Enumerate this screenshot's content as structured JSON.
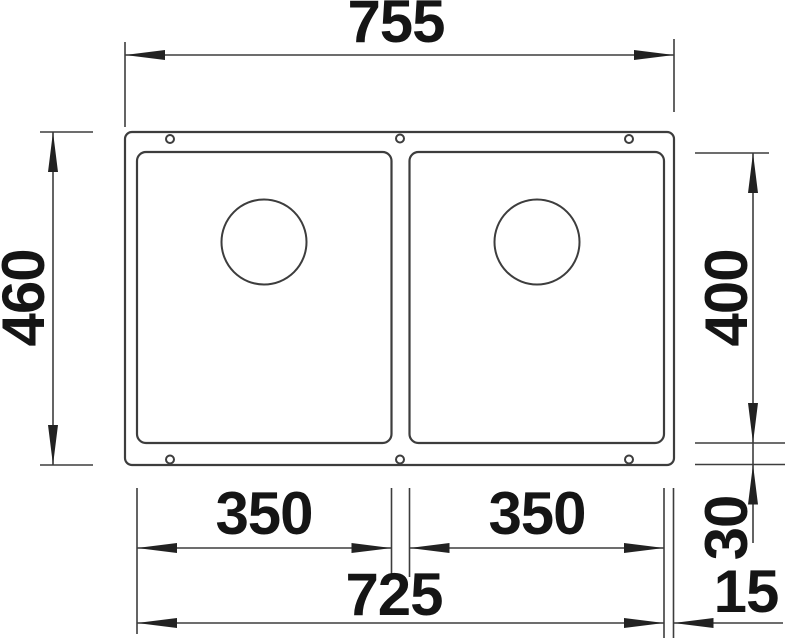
{
  "diagram": {
    "type": "technical-dimension-drawing",
    "depicts": "double-bowl undermount sink, top view with outer rim, two bowls, drain circles and fixing holes",
    "colors": {
      "background": "#ffffff",
      "line": "#3d3d3d",
      "text": "#151515"
    },
    "labels": {
      "overall_width": "755",
      "overall_depth": "460",
      "bowl_depth": "400",
      "left_bowl_width": "350",
      "right_bowl_width": "350",
      "cutout_width": "725",
      "bottom_gap": "30",
      "side_gap": "15"
    }
  }
}
